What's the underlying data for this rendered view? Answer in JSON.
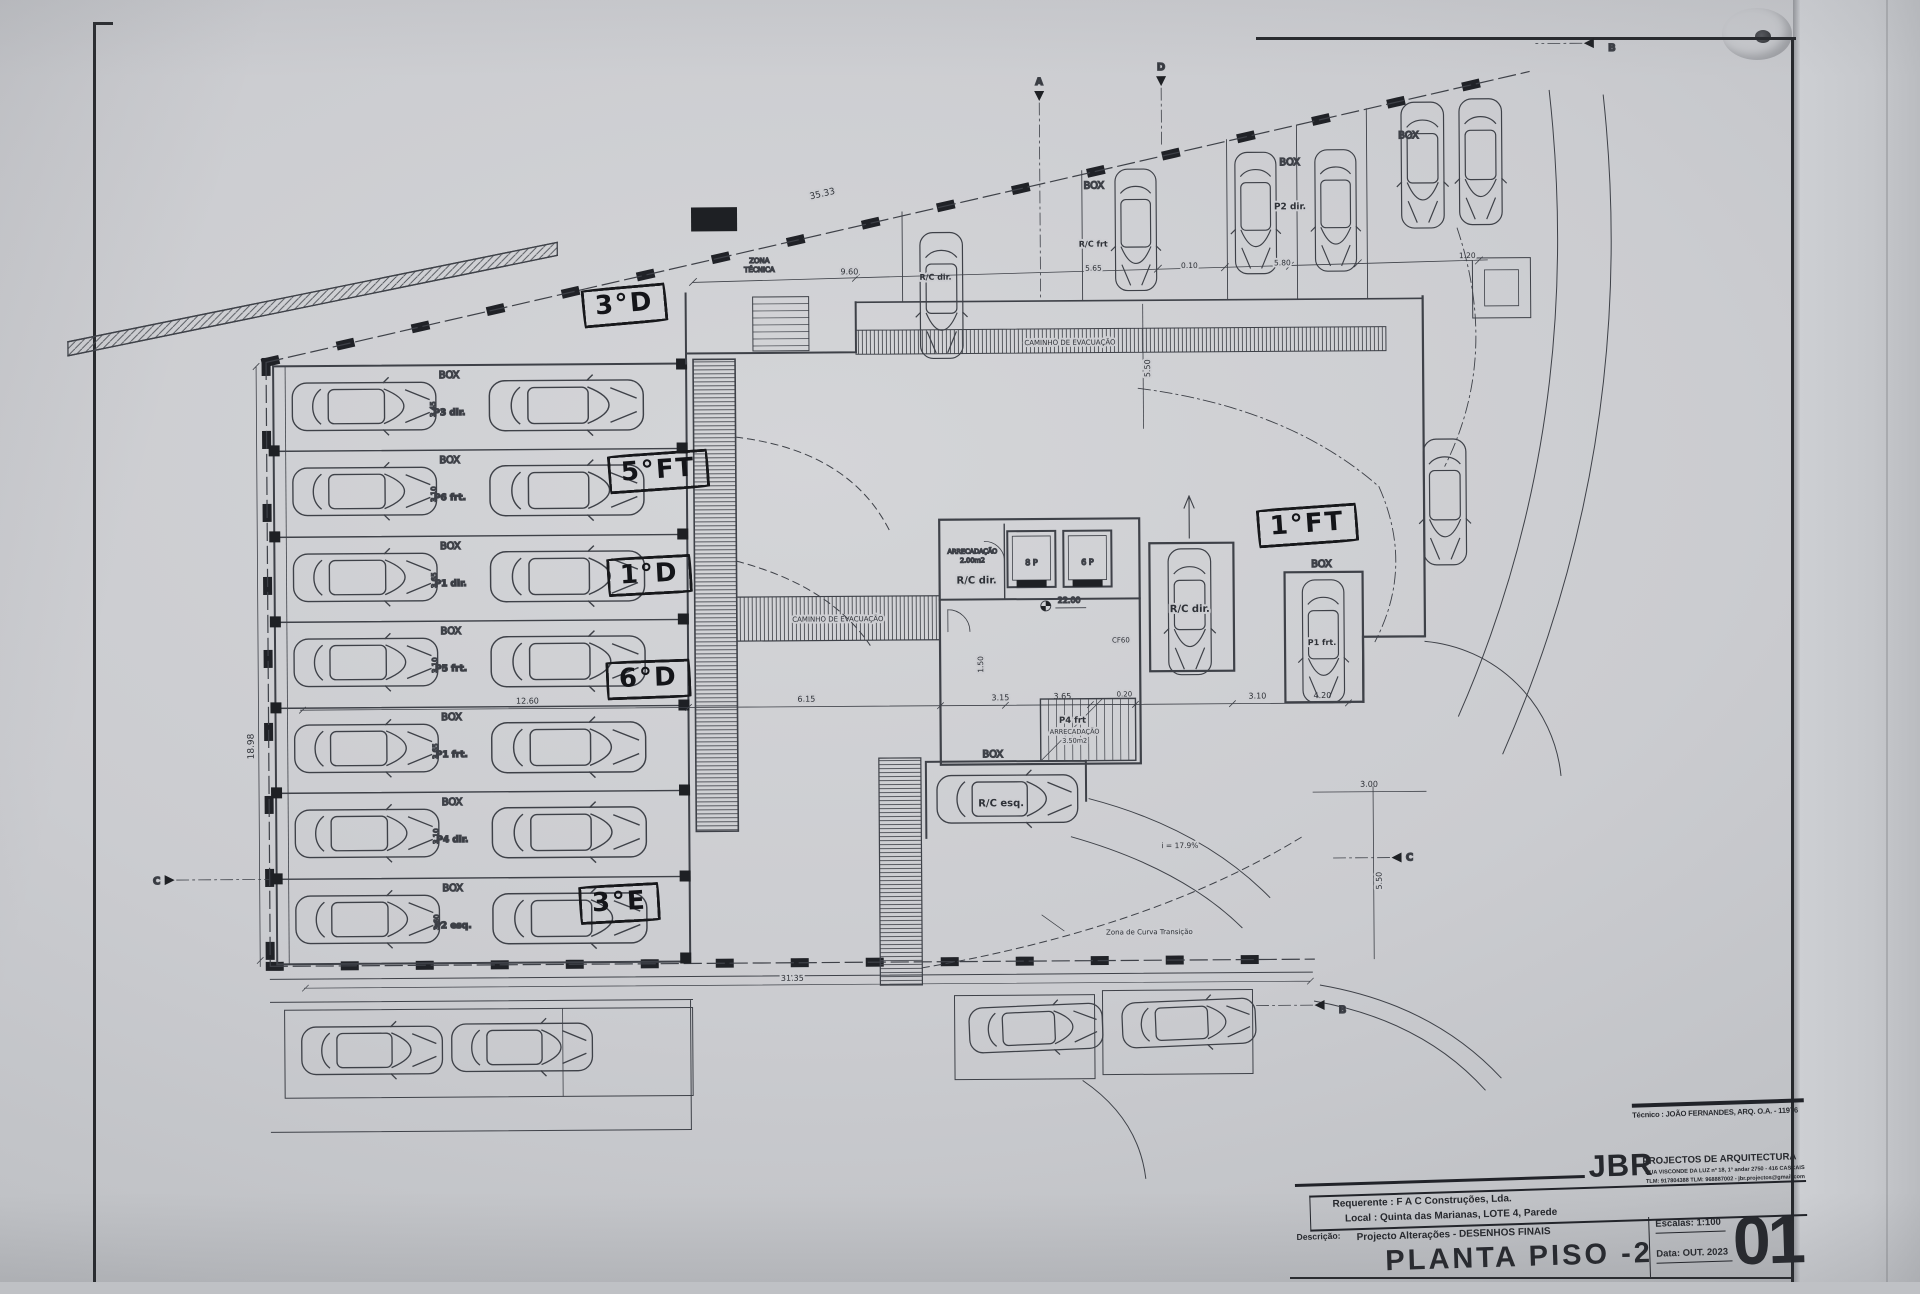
{
  "photo": {
    "paper_color": "#cdced2",
    "line_color": "#3e4148",
    "ink_color": "#17181b"
  },
  "handwritten": [
    {
      "text": "3°D"
    },
    {
      "text": "5°FT"
    },
    {
      "text": "1°D"
    },
    {
      "text": "6°D"
    },
    {
      "text": "3°E"
    },
    {
      "text": "1°FT"
    }
  ],
  "plan": {
    "labels": {
      "box": "BOX",
      "rc_frt": "R/C frt",
      "rc_dir": "R/C dir.",
      "rc_esq": "R/C esq.",
      "p2_dir": "P2 dir.",
      "p1_frt": "P1 frt.",
      "p4_frt": "P4 frt",
      "arrec": "ARRECADAÇÃO",
      "arrec1_area": "2.00m2",
      "arrec2_area": "3.50m2",
      "lift_8p": "8 P",
      "lift_6p": "6 P",
      "cf60": "CF60",
      "slope": "i = 17.9%",
      "zona_curva": "Zona de Curva Transição",
      "zona_tecnica_l1": "ZONA",
      "zona_tecnica_l2": "TÉCNICA",
      "caminho": "CAMINHO  DE  EVACUAÇÃO"
    },
    "left_rows": [
      {
        "code": "P3 dir.",
        "dim": "3.45"
      },
      {
        "code": "P6 frt.",
        "dim": "3.10"
      },
      {
        "code": "P1 dir.",
        "dim": "3.65"
      },
      {
        "code": "P5 frt.",
        "dim": "3.10"
      },
      {
        "code": "P1 frt.",
        "dim": "3.65"
      },
      {
        "code": "P4 dir.",
        "dim": "3.10"
      },
      {
        "code": "P2 esq.",
        "dim": "3.60"
      }
    ],
    "dims": {
      "total_top": "35.33",
      "d9_60": "9.60",
      "d5_65": "5.65",
      "d0_10": "0.10",
      "d5_80": "5.80",
      "d1_20": "1.20",
      "left_total": "18.98",
      "bottom_total": "31.35",
      "d12_60": "12.60",
      "d6_15": "6.15",
      "d3_15": "3.15",
      "d3_65": "3.65",
      "d0_20": "0.20",
      "d3_10": "3.10",
      "d4_20": "4.20",
      "d3_00": "3.00",
      "d5_50": "5.50",
      "d1_50": "1.50",
      "level": "22.00"
    },
    "sections": {
      "a": "A",
      "b": "B",
      "c": "C",
      "d": "D"
    }
  },
  "titleblock": {
    "tecnico": "Técnico : JOÃO FERNANDES, ARQ.   O.A. - 11976",
    "firm": {
      "name": "JBR",
      "tagline": "PROJECTOS DE ARQUITECTURA",
      "address": "RUA VISCONDE DA LUZ nº 18, 1º andar  2750 - 416  CASCAIS",
      "contacts": "TLM: 917804388  TLM: 968887002 - jbr.projectos@gmail.com"
    },
    "rows": {
      "requerente_label": "Requerente :",
      "requerente_value": "F A C  Construções, Lda.",
      "local_label": "Local :",
      "local_value": "Quinta das Marianas, LOTE 4, Parede",
      "descricao_label": "Descrição:",
      "descricao_value": "Projecto Alterações - DESENHOS FINAIS"
    },
    "title": "PLANTA PISO -2",
    "escalas": "Escalas: 1:100",
    "data": "Data: OUT. 2023",
    "sheet": "01"
  }
}
